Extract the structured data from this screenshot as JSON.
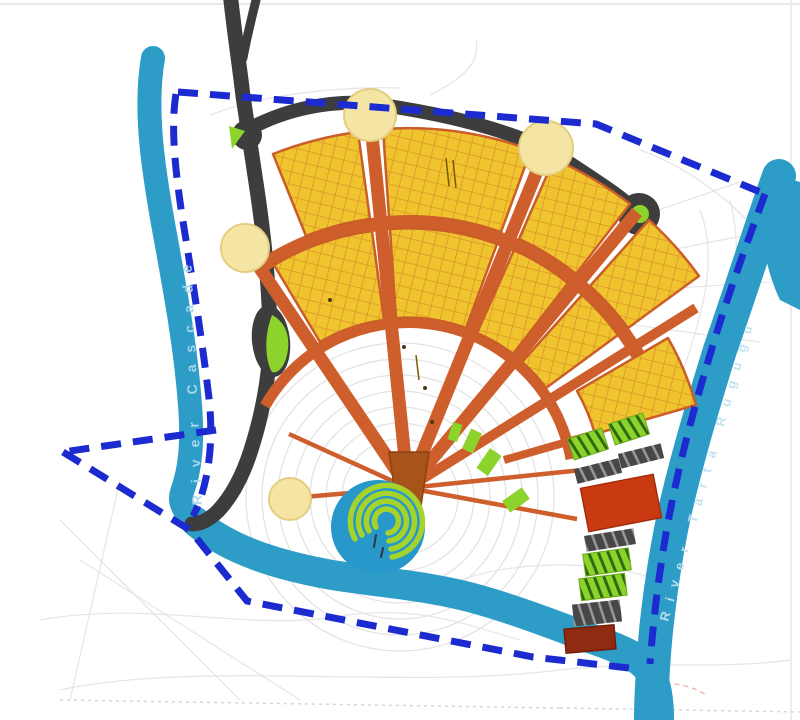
{
  "map": {
    "type": "urban-master-plan",
    "rivers": {
      "left_label": "River Cascade",
      "right_label": "River Tarta Rugugu"
    },
    "features": {
      "boundary_style": "dashed",
      "yellow_superblocks": 9,
      "radial_roads": 6,
      "cream_nodes": 4,
      "roundabouts": 1,
      "green_striped_parcels": 4,
      "gray_striped_parcels": 4,
      "red_parcels": 1,
      "dark_red_parcels": 1
    },
    "colors": {
      "boundary": "#1B2BD0",
      "water": "#2D9DC8",
      "road_dark": "#3D3D3D",
      "road_orange": "#CE5E2B",
      "block_yellow": "#EFC42E",
      "block_grid": "#D78C2A",
      "node_cream": "#F4E5A4",
      "green": "#8CD42B",
      "green_stripe_dark": "#2F6B0E",
      "gray_parcel": "#474747",
      "gray_parcel_stripe": "#9A9A9A",
      "parcel_red": "#C93A12",
      "parcel_dark_red": "#8E2B10",
      "center_blue": "#2897C9",
      "center_spiral": "#A6D32B",
      "apex_brown": "#A8531A",
      "contour": "#DEDEDE"
    }
  }
}
